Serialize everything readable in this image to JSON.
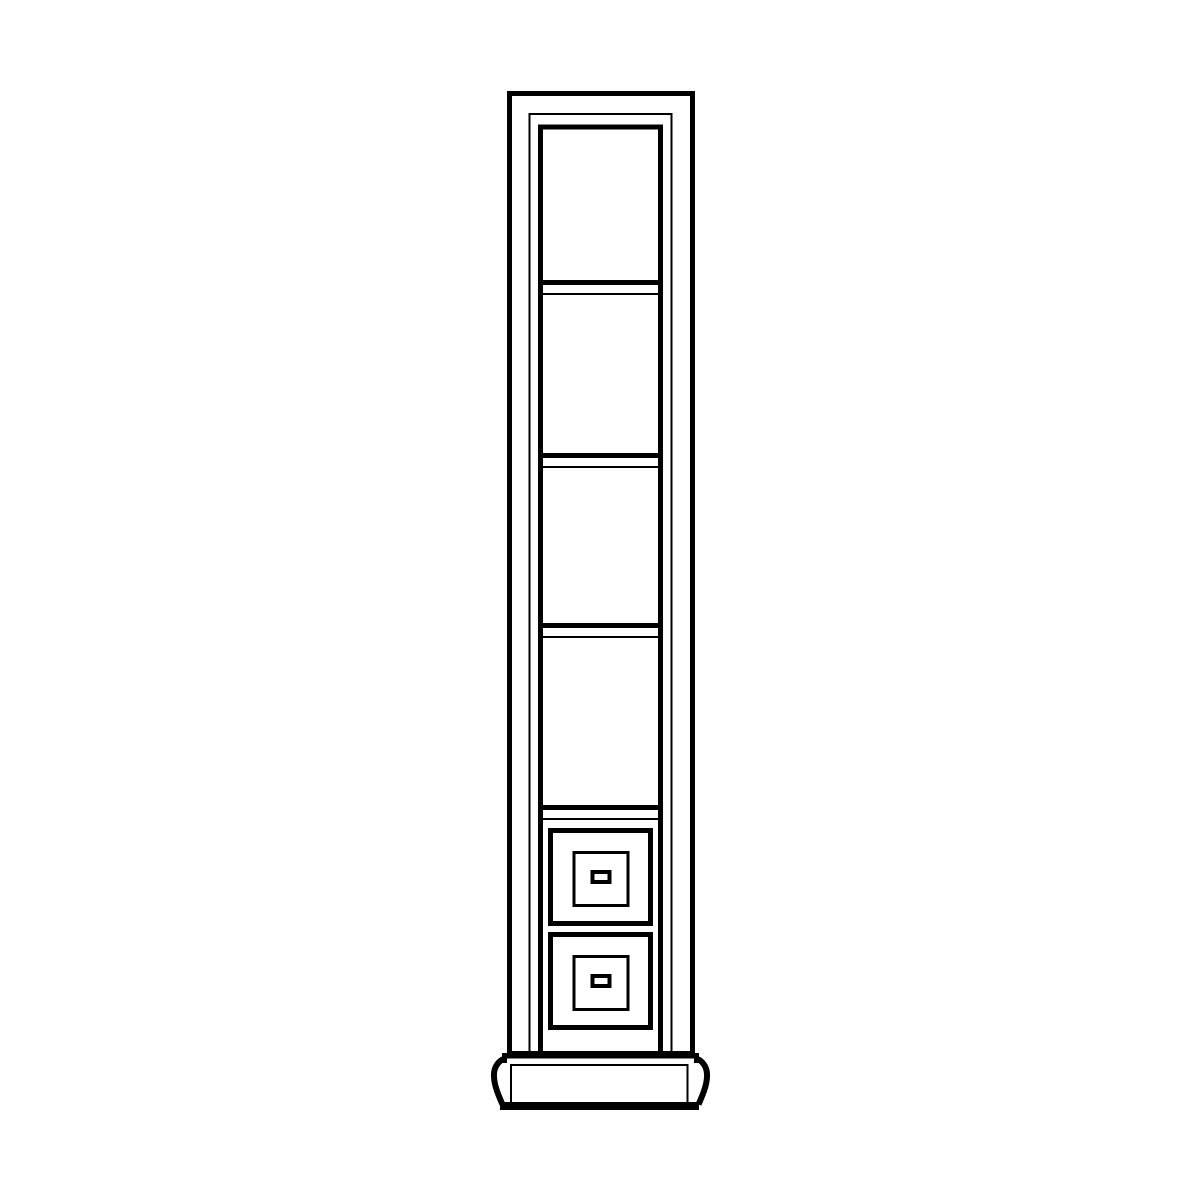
{
  "colors": {
    "line": "#000000",
    "background": "#ffffff"
  },
  "illustration": {
    "name": "tall-narrow-bookcase-with-drawers",
    "description": "Black and white line drawing of a tall, narrow bookcase column with four open shelf compartments above two square drawers, standing on a molded plinth base with curved sides.",
    "shelf_compartment_count": 4,
    "drawer_count": 2,
    "shelf_divider_y": [
      280,
      453,
      623,
      805
    ],
    "drawer_top_y": [
      828,
      932
    ]
  }
}
